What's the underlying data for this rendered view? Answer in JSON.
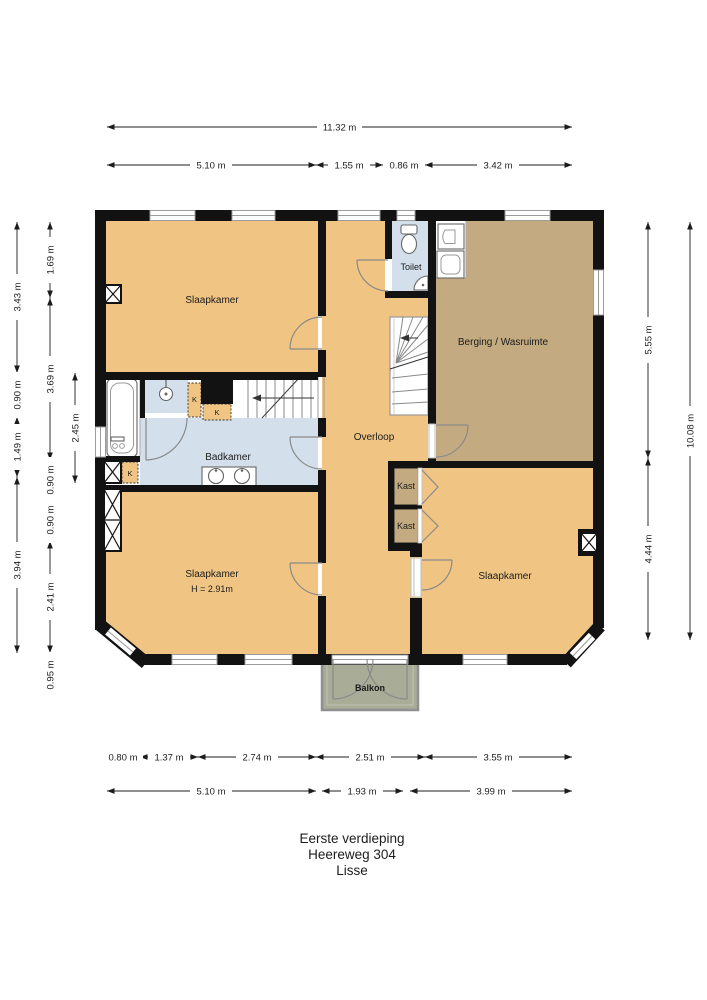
{
  "meta": {
    "title_lines": [
      "Eerste verdieping",
      "Heereweg 304",
      "Lisse"
    ]
  },
  "rooms": {
    "slaapkamer_nw": {
      "label": "Slaapkamer"
    },
    "toilet": {
      "label": "Toilet"
    },
    "berging": {
      "label": "Berging / Wasruimte"
    },
    "overloop": {
      "label": "Overloop"
    },
    "badkamer": {
      "label": "Badkamer"
    },
    "kast_top": {
      "label": "Kast"
    },
    "kast_bottom": {
      "label": "Kast"
    },
    "slaapkamer_sw": {
      "label": "Slaapkamer",
      "height_note": "H = 2.91m"
    },
    "slaapkamer_se": {
      "label": "Slaapkamer"
    },
    "balkon": {
      "label": "Balkon"
    },
    "closet_k1": {
      "label": "K"
    },
    "closet_k2": {
      "label": "K"
    },
    "closet_k3": {
      "label": "K"
    }
  },
  "dimensions": {
    "top_total": "11.32 m",
    "top_segments": [
      "5.10 m",
      "1.55 m",
      "0.86 m",
      "3.42 m"
    ],
    "bottom_upper": [
      "0.80 m",
      "1.37 m",
      "2.74 m",
      "2.51 m",
      "3.55 m"
    ],
    "bottom_lower": [
      "5.10 m",
      "1.93 m",
      "3.99 m"
    ],
    "left_col1": [
      "3.43 m",
      "0.90 m",
      "1.49 m",
      "3.94 m"
    ],
    "left_col2": [
      "1.69 m",
      "3.69 m",
      "0.90 m",
      "0.90 m",
      "2.41 m",
      "0.95 m"
    ],
    "left_col3": [
      "2.45 m"
    ],
    "right_col1": [
      "5.55 m",
      "4.44 m"
    ],
    "right_col2": [
      "10.08 m"
    ]
  },
  "colors": {
    "room_orange": "#F0C482",
    "room_tan": "#C4AA80",
    "room_blue": "#D3E0EC",
    "balcony_fill": "#A9AC97",
    "wall": "#121212"
  }
}
